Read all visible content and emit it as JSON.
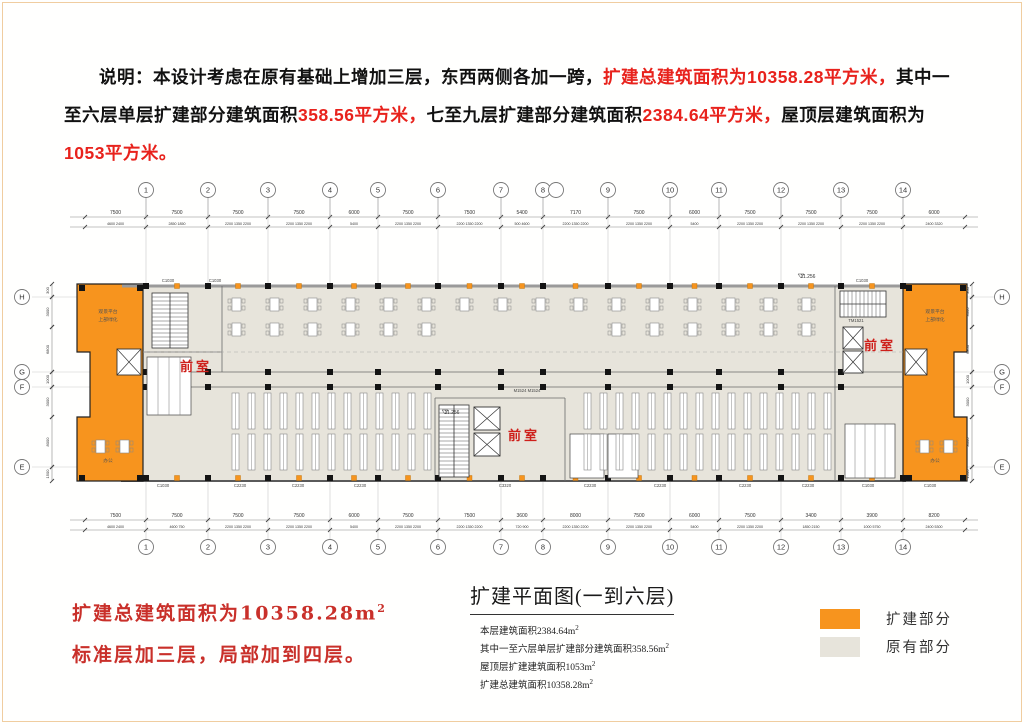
{
  "description": {
    "segments": [
      {
        "text": "说明：本设计考虑在原有基础上增加三层，东西两侧各加一跨，",
        "color": "black"
      },
      {
        "text": "扩建总建筑面积为10358.28平方米，",
        "color": "red"
      },
      {
        "text": "其中一至六层单层扩建部分建筑面积",
        "color": "black"
      },
      {
        "text": "358.56平方米，",
        "color": "red"
      },
      {
        "text": "七至九层扩建部分建筑面积",
        "color": "black"
      },
      {
        "text": "2384.64平方米，",
        "color": "red"
      },
      {
        "text": "屋顶层建筑面积为",
        "color": "black"
      },
      {
        "text": "1053平方米。",
        "color": "red"
      }
    ]
  },
  "plan": {
    "grid_columns": [
      {
        "label": "1",
        "x": 146
      },
      {
        "label": "2",
        "x": 208
      },
      {
        "label": "3",
        "x": 268
      },
      {
        "label": "4",
        "x": 330
      },
      {
        "label": "5",
        "x": 378
      },
      {
        "label": "6",
        "x": 438
      },
      {
        "label": "7",
        "x": 501
      },
      {
        "label": "8",
        "x": 543
      },
      {
        "label": "9",
        "x": 608
      },
      {
        "label": "10",
        "x": 670
      },
      {
        "label": "11",
        "x": 719
      },
      {
        "label": "12",
        "x": 781
      },
      {
        "label": "13",
        "x": 841
      },
      {
        "label": "14",
        "x": 903
      }
    ],
    "grid_rows": [
      {
        "label": "H",
        "y": 297
      },
      {
        "label": "G",
        "y": 372
      },
      {
        "label": "F",
        "y": 387
      },
      {
        "label": "E",
        "y": 467
      }
    ],
    "top_dims": [
      "7500",
      "7500",
      "7500",
      "7500",
      "6000",
      "7500",
      "7500",
      "5400",
      "7170",
      "7500",
      "6000",
      "7500",
      "7500",
      "7500",
      "6000"
    ],
    "top_sub_dims": [
      "4600 2400",
      "2850 1850",
      "2200 1350 2200",
      "2200 1350 2200",
      "5400",
      "2200 1350 2200",
      "2200 1350 2200",
      "500 4600",
      "2200 1350 2200",
      "2200 1350 2200",
      "5400",
      "2200 1350 2200",
      "2200 1350 2200",
      "2200 1350 2200",
      "2400 3320"
    ],
    "bottom_dims": [
      "7500",
      "7500",
      "7500",
      "7500",
      "6000",
      "7500",
      "7500",
      "3600",
      "8000",
      "7500",
      "6000",
      "7500",
      "3400",
      "3900",
      "8200"
    ],
    "bottom_sub_dims": [
      "4600 2400",
      "4600 750",
      "2200 1350 2200",
      "2200 1350 2200",
      "5400",
      "2200 1350 2200",
      "2200 1350 2200",
      "720 900",
      "2200 1350 2200",
      "2200 1350 2200",
      "5400",
      "2200 1350 2200",
      "1850 2150",
      "1000 5750",
      "2400 5300"
    ],
    "side_dims": [
      {
        "y1": 284,
        "y2": 297,
        "label": "300"
      },
      {
        "y1": 297,
        "y2": 327,
        "label": "3000"
      },
      {
        "y1": 327,
        "y2": 372,
        "label": "6800"
      },
      {
        "y1": 372,
        "y2": 387,
        "label": "1000"
      },
      {
        "y1": 387,
        "y2": 417,
        "label": "3000"
      },
      {
        "y1": 417,
        "y2": 467,
        "label": "8000"
      },
      {
        "y1": 467,
        "y2": 481,
        "label": "1500"
      }
    ],
    "vestibule_label": "前室",
    "vestibules": [
      {
        "x": 196,
        "y": 371
      },
      {
        "x": 524,
        "y": 440
      },
      {
        "x": 880,
        "y": 350
      }
    ],
    "elevation_marks": [
      {
        "x": 808,
        "y": 278,
        "label": "11.256"
      },
      {
        "x": 452,
        "y": 414,
        "label": "11.256"
      }
    ],
    "door_labels": [
      {
        "x": 527,
        "y": 392,
        "label": "M1524 M1524"
      },
      {
        "x": 856,
        "y": 322,
        "label": "TM1521"
      }
    ],
    "window_labels_bottom": [
      "C1030",
      "C2230",
      "C2230",
      "C2230",
      "C3320",
      "C2230",
      "C2230",
      "C2230",
      "C2230",
      "C1030",
      "C1030"
    ],
    "window_labels_bottom_x": [
      163,
      240,
      298,
      360,
      505,
      590,
      660,
      745,
      808,
      868,
      930
    ],
    "window_labels_top": [
      {
        "x": 168,
        "y": 282,
        "label": "C1030"
      },
      {
        "x": 215,
        "y": 282,
        "label": "C1030"
      },
      {
        "x": 862,
        "y": 282,
        "label": "C1030"
      }
    ],
    "room_labels": [
      {
        "x": 108,
        "y": 313,
        "label": "观景平台"
      },
      {
        "x": 108,
        "y": 321,
        "label": "上部绿化"
      },
      {
        "x": 935,
        "y": 313,
        "label": "观景平台"
      },
      {
        "x": 935,
        "y": 321,
        "label": "上部绿化"
      },
      {
        "x": 108,
        "y": 462,
        "label": "办公"
      },
      {
        "x": 935,
        "y": 462,
        "label": "办公"
      }
    ],
    "colors": {
      "expansion": "#F7941E",
      "existing": "#E7E4DB",
      "column": "#141414",
      "red_label": "#CE1F1A",
      "grid_line": "#c9c9c9",
      "wall": "#5a5a5a"
    }
  },
  "red_note": {
    "line1": "扩建总建筑面积为10358.28m",
    "line1_sup": "2",
    "line2": "标准层加三层，局部加到四层。"
  },
  "caption": {
    "title": "扩建平面图(一到六层)",
    "lines": [
      {
        "text": "本层建筑面积2384.64m",
        "sup": "2"
      },
      {
        "text": "其中一至六层单层扩建部分建筑面积358.56m",
        "sup": "2"
      },
      {
        "text": "屋顶层扩建建筑面积1053m",
        "sup": "2"
      },
      {
        "text": "扩建总建筑面积10358.28m",
        "sup": "2"
      }
    ]
  },
  "legend": {
    "items": [
      {
        "label": "扩建部分",
        "color": "#F7941E"
      },
      {
        "label": "原有部分",
        "color": "#E7E4DB"
      }
    ]
  }
}
